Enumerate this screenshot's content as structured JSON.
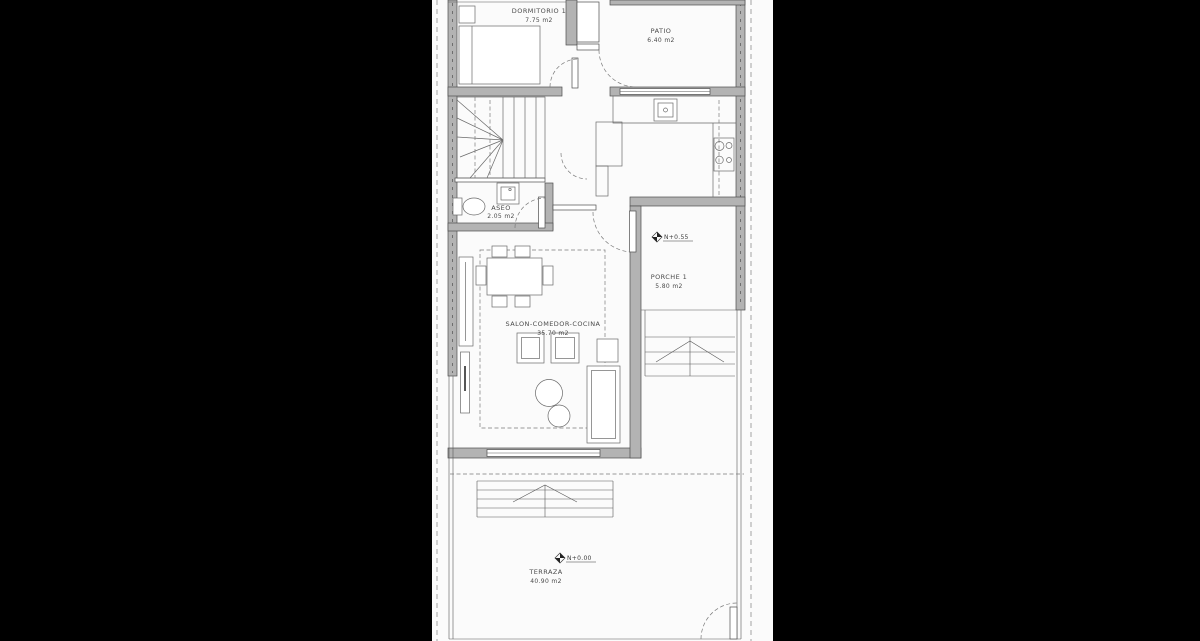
{
  "meta": {
    "kind": "architectural floor plan, letterboxed photo"
  },
  "colors": {
    "letterbox": "#000000",
    "paper": "#fbfbfb",
    "wall": "#b3b3b3",
    "line": "#4d4d4d",
    "text": "#4a4a4a"
  },
  "rooms": [
    {
      "id": "dormitorio-1",
      "label": "DORMITORIO 1",
      "area": "7.75 m2"
    },
    {
      "id": "patio",
      "label": "PATIO",
      "area": "6.40 m2"
    },
    {
      "id": "aseo",
      "label": "ASEO",
      "area": "2.05 m2"
    },
    {
      "id": "salon",
      "label": "SALON-COMEDOR-COCINA",
      "area": "35.70 m2"
    },
    {
      "id": "porche-1",
      "label": "PORCHE 1",
      "area": "5.80 m2"
    },
    {
      "id": "terraza",
      "label": "TERRAZA",
      "area": "40.90 m2"
    }
  ],
  "level_markers": [
    {
      "id": "porche-level",
      "label": "N+0.55"
    },
    {
      "id": "terraza-level",
      "label": "N+0.00"
    }
  ]
}
